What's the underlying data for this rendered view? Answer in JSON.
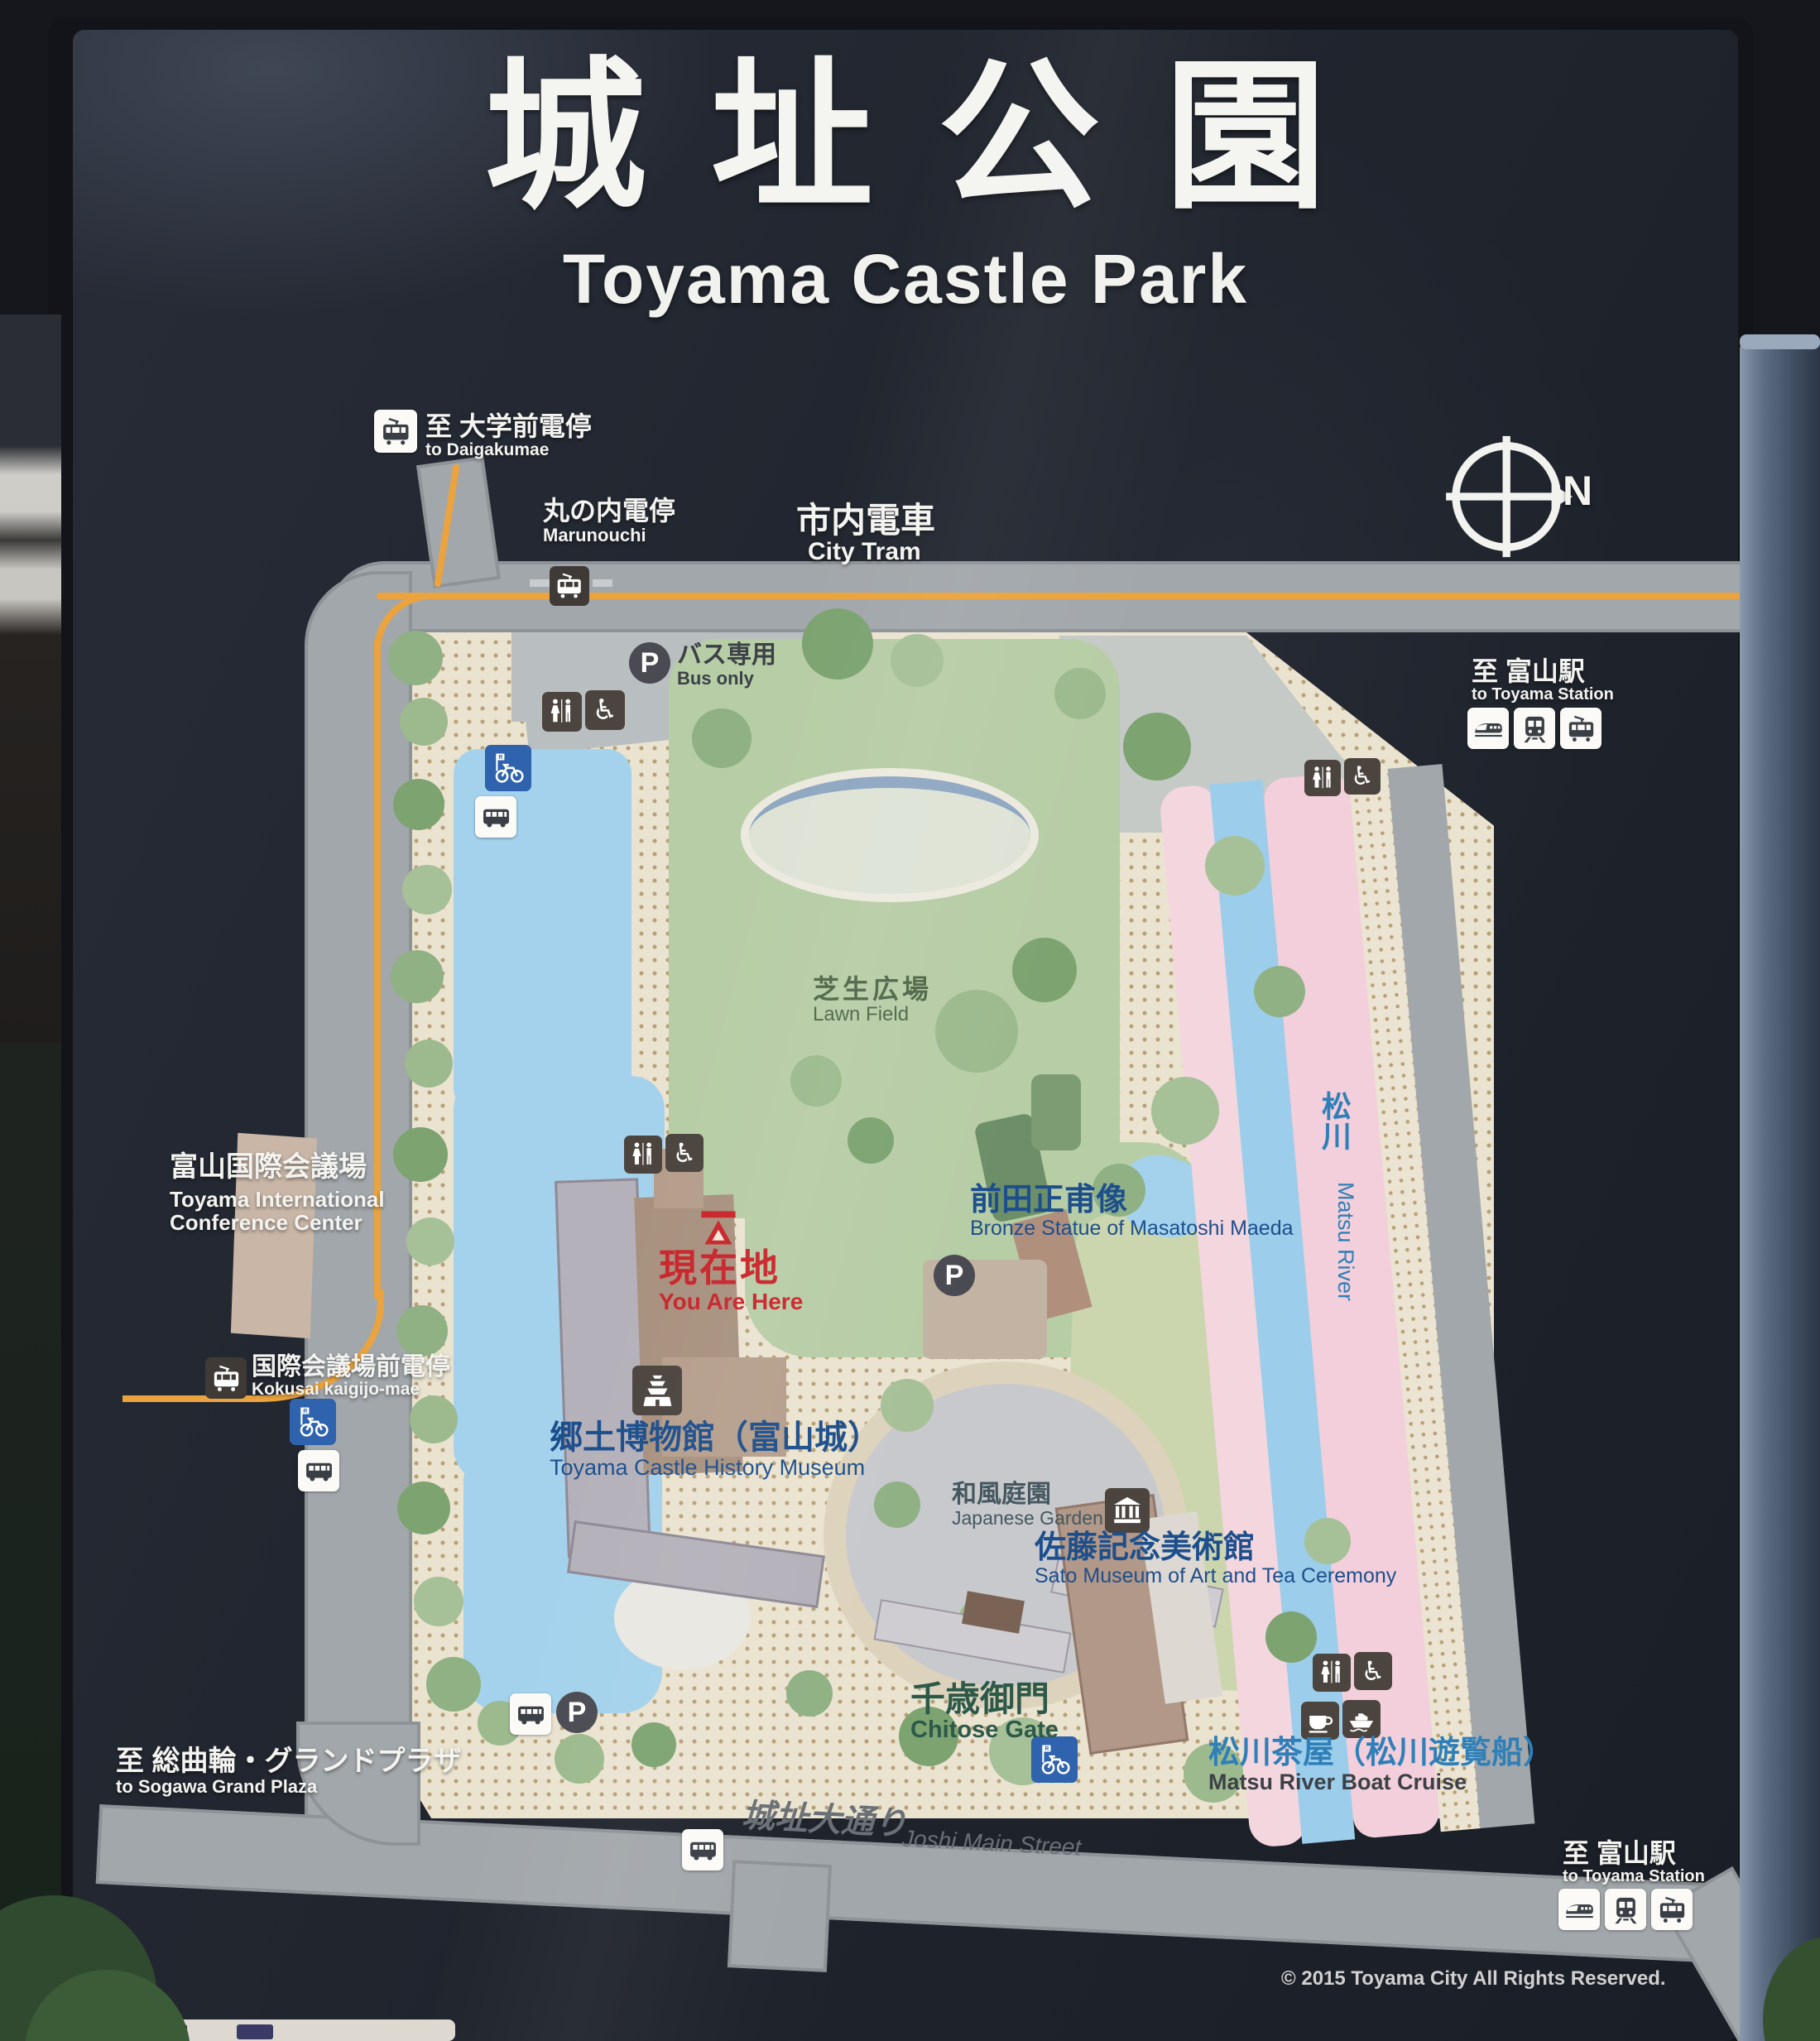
{
  "header": {
    "title_jp": "城址公園",
    "title_en": "Toyama Castle Park"
  },
  "compass": {
    "north_label": "N"
  },
  "exits": {
    "daigakumae": {
      "jp": "至 大学前電停",
      "en": "to Daigakumae"
    },
    "toyama_station_top": {
      "jp": "至 富山駅",
      "en": "to Toyama Station"
    },
    "toyama_station_bottom": {
      "jp": "至 富山駅",
      "en": "to Toyama Station"
    },
    "sogawa": {
      "jp": "至 総曲輪・グランドプラザ",
      "en": "to Sogawa  Grand Plaza"
    }
  },
  "tram": {
    "city_tram": {
      "jp": "市内電車",
      "en": "City Tram"
    },
    "marunouchi": {
      "jp": "丸の内電停",
      "en": "Marunouchi"
    },
    "kokusai": {
      "jp": "国際会議場前電停",
      "en": "Kokusai kaigijo-mae"
    }
  },
  "facilities": {
    "bus_parking": {
      "jp": "バス専用",
      "en": "Bus only"
    },
    "lawn_field": {
      "jp": "芝生広場",
      "en": "Lawn Field"
    },
    "conference_center": {
      "jp": "富山国際会議場",
      "en1": "Toyama International",
      "en2": "Conference Center"
    },
    "you_are_here": {
      "jp": "現在地",
      "en": "You Are Here"
    },
    "maeda_statue": {
      "jp": "前田正甫像",
      "en": "Bronze Statue of Masatoshi Maeda"
    },
    "matsu_river": {
      "jp": "松川",
      "en": "Matsu River"
    },
    "history_museum": {
      "jp": "郷土博物館（富山城）",
      "en": "Toyama Castle History Museum"
    },
    "japanese_garden": {
      "jp": "和風庭園",
      "en": "Japanese Garden"
    },
    "sato_museum": {
      "jp": "佐藤記念美術館",
      "en": "Sato Museum of Art and Tea Ceremony"
    },
    "chitose_gate": {
      "jp": "千歳御門",
      "en": "Chitose Gate"
    },
    "joshi_street": {
      "jp": "城址大通り",
      "en": "Joshi Main Street"
    },
    "boat_cruise": {
      "jp": "松川茶屋（松川遊覧船）",
      "en": "Matsu River Boat Cruise"
    }
  },
  "copyright": "© 2015 Toyama City All Rights Reserved.",
  "colors": {
    "sign_bg": "#232833",
    "road": "#a2a7ab",
    "tram_line": "#eaa33e",
    "park_ground": "#eae3d0",
    "lawn": "#b7cda6",
    "water": "#a4d2ec",
    "cherry_pink": "#f3d4de",
    "you_are_here_red": "#c9252b",
    "label_blue": "#1d4f8c",
    "bicycle_blue": "#2f63ae"
  },
  "icons": {
    "tram": "tram-icon",
    "shinkansen": "shinkansen-icon",
    "train": "train-icon",
    "bus": "bus-icon",
    "bicycle_rental": "bicycle-rental-icon",
    "toilet": "toilet-icon",
    "wheelchair": "wheelchair-icon ♿",
    "parking": "parking-icon P",
    "castle": "castle-icon",
    "museum": "museum-icon",
    "teahouse": "teacup-icon",
    "boat": "boat-icon",
    "compass": "compass-icon",
    "marker": "you-are-here-marker"
  }
}
